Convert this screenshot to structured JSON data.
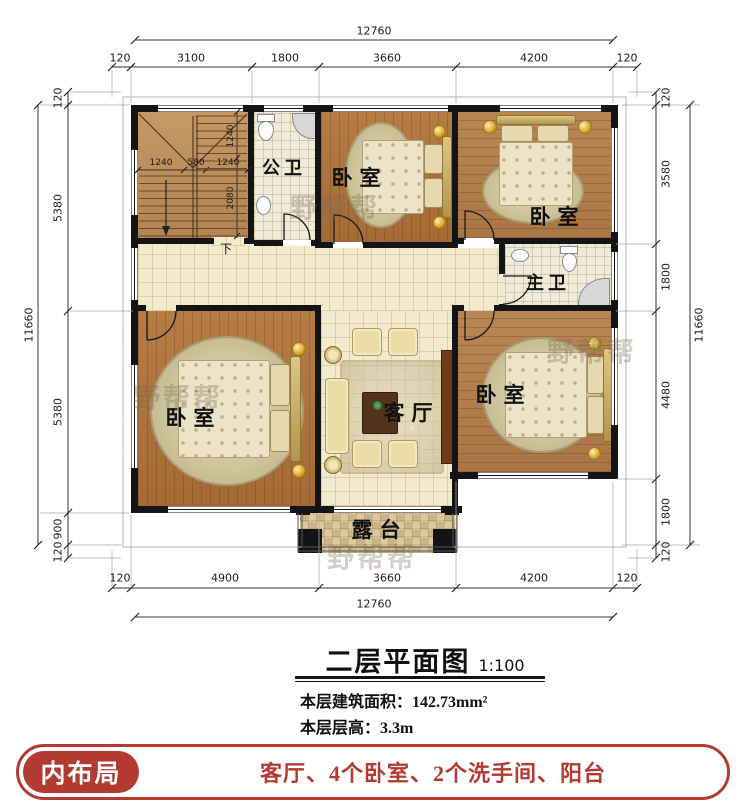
{
  "title": {
    "text": "二层平面图",
    "scale": "1:100"
  },
  "notes": [
    "本层建筑面积：142.73mm²",
    "本层层高：3.3m"
  ],
  "rooms": {
    "bedroom": "卧室",
    "bath_shared": "公卫",
    "bath_master": "主卫",
    "living": "客厅",
    "terrace": "露台",
    "stair_down": "下"
  },
  "dims": {
    "top_total": "12760",
    "top": [
      "120",
      "3100",
      "1800",
      "3660",
      "4200",
      "120"
    ],
    "bottom": [
      "120",
      "4900",
      "3660",
      "4200",
      "120"
    ],
    "bottom_total": "12760",
    "left_total": "11660",
    "left": [
      "120",
      "5380",
      "5380",
      "900",
      "120"
    ],
    "right": [
      "120",
      "3580",
      "1800",
      "4480",
      "1800",
      "120"
    ],
    "right_total": "11660",
    "stair_h": [
      "1240",
      "580",
      "1240"
    ],
    "stair_v": [
      "1240",
      "2080"
    ]
  },
  "banner": {
    "label": "内布局",
    "items": "客厅、4个卧室、2个洗手间、阳台"
  },
  "watermark": "野帮帮",
  "colors": {
    "banner_red": "#b23a31",
    "wall": "#141414",
    "wood": "#b2743a",
    "tile": "#f3e9cd",
    "terrace_tile": "#dcc9a1"
  }
}
